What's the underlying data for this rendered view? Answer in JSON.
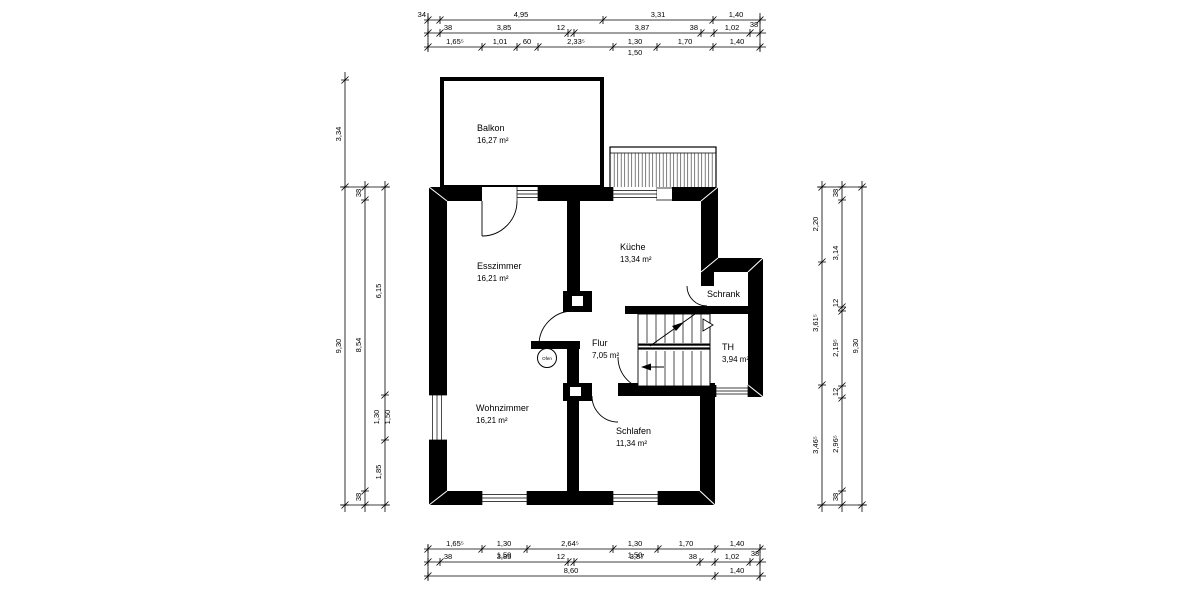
{
  "plan_title": "floor-plan",
  "rooms": {
    "balkon": {
      "name": "Balkon",
      "area": "16,27 m²"
    },
    "esszimmer": {
      "name": "Esszimmer",
      "area": "16,21 m²"
    },
    "kueche": {
      "name": "Küche",
      "area": "13,34 m²"
    },
    "schrank": {
      "name": "Schrank"
    },
    "flur": {
      "name": "Flur",
      "area": "7,05 m²"
    },
    "th": {
      "name": "TH",
      "area": "3,94 m²"
    },
    "wohnzimmer": {
      "name": "Wohnzimmer",
      "area": "16,21 m²"
    },
    "schlafen": {
      "name": "Schlafen",
      "area": "11,34 m²"
    },
    "ofen": {
      "name": "Ofen"
    }
  },
  "dimensions": {
    "top": {
      "row1": [
        "34",
        "4,95",
        "3,31",
        "1,40"
      ],
      "row1_wall": "38",
      "row2": [
        "38",
        "3,85",
        "12",
        "3,87",
        "38",
        "1,02"
      ],
      "row3": [
        "1,65⁵",
        "1,01",
        "60",
        "2,33⁵",
        "1,30",
        "1,50",
        "1,70",
        "1,40"
      ]
    },
    "bottom": {
      "row1": [
        "1,65⁵",
        "1,30",
        "1,50",
        "2,64⁵",
        "1,30",
        "1,50",
        "1,70",
        "1,40"
      ],
      "row2": [
        "38",
        "3,85",
        "12",
        "3,87",
        "38",
        "1,02"
      ],
      "row2_wall": "38",
      "row3": [
        "8,60",
        "1,40"
      ]
    },
    "left": {
      "col1": [
        "3,34",
        "9,30"
      ],
      "col2": [
        "38",
        "8,54",
        "38"
      ],
      "col3": [
        "6,15",
        "1,30",
        "1,50",
        "1,85"
      ]
    },
    "right": {
      "col1": [
        "2,20",
        "3,61⁵",
        "3,46⁵"
      ],
      "col2": [
        "38",
        "3,14",
        "12",
        "2,19⁵",
        "12",
        "2,96⁵",
        "38"
      ],
      "col3": [
        "9,30"
      ]
    }
  },
  "colors": {
    "wall": "#000000",
    "background": "#ffffff"
  }
}
